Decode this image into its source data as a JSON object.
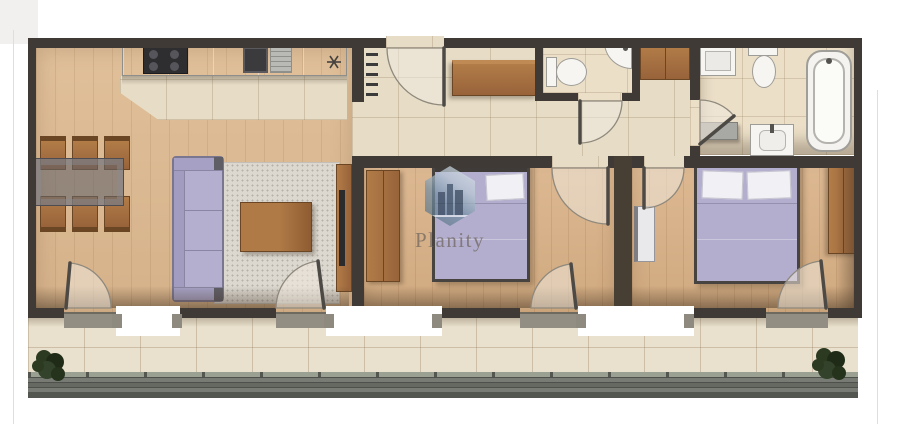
{
  "watermark": {
    "brand": "Planity"
  },
  "plan": {
    "type": "2-bedroom apartment floor plan, top-down 3D render",
    "rooms": [
      {
        "id": "living-room-kitchen",
        "furniture": [
          "kitchen counter",
          "cooktop",
          "kitchen sink",
          "dining table",
          "6 dining chairs",
          "sofa",
          "rug",
          "coffee table",
          "tv stand",
          "tv"
        ]
      },
      {
        "id": "entrance-hall",
        "furniture": [
          "entrance door",
          "radiator",
          "sideboard",
          "closet"
        ]
      },
      {
        "id": "wc",
        "furniture": [
          "toilet",
          "corner sink"
        ]
      },
      {
        "id": "bathroom",
        "furniture": [
          "washing machine",
          "toilet",
          "bathtub",
          "vanity sink",
          "shelf"
        ]
      },
      {
        "id": "bedroom-1",
        "furniture": [
          "double bed",
          "pillow",
          "wardrobe"
        ]
      },
      {
        "id": "bedroom-2",
        "furniture": [
          "double bed",
          "2 pillows",
          "wardrobe",
          "cabinet"
        ]
      },
      {
        "id": "balcony",
        "furniture": [
          "2 plants",
          "railing",
          "4 balcony doors"
        ]
      }
    ],
    "door_count": 9
  },
  "palette": {
    "wall": "#3f3a36",
    "wood_floor": "#dcba93",
    "tile_floor": "#e7ddc7",
    "sofa_and_beds": "#b4afcf",
    "wood_furniture": "#a9713d",
    "kitchen_counter": "#c9cac6",
    "rug": "#dcd8d0",
    "balcony_railing": "#6e716a",
    "plant": "#2c3a21",
    "watermark_hex": "#7590a5"
  }
}
